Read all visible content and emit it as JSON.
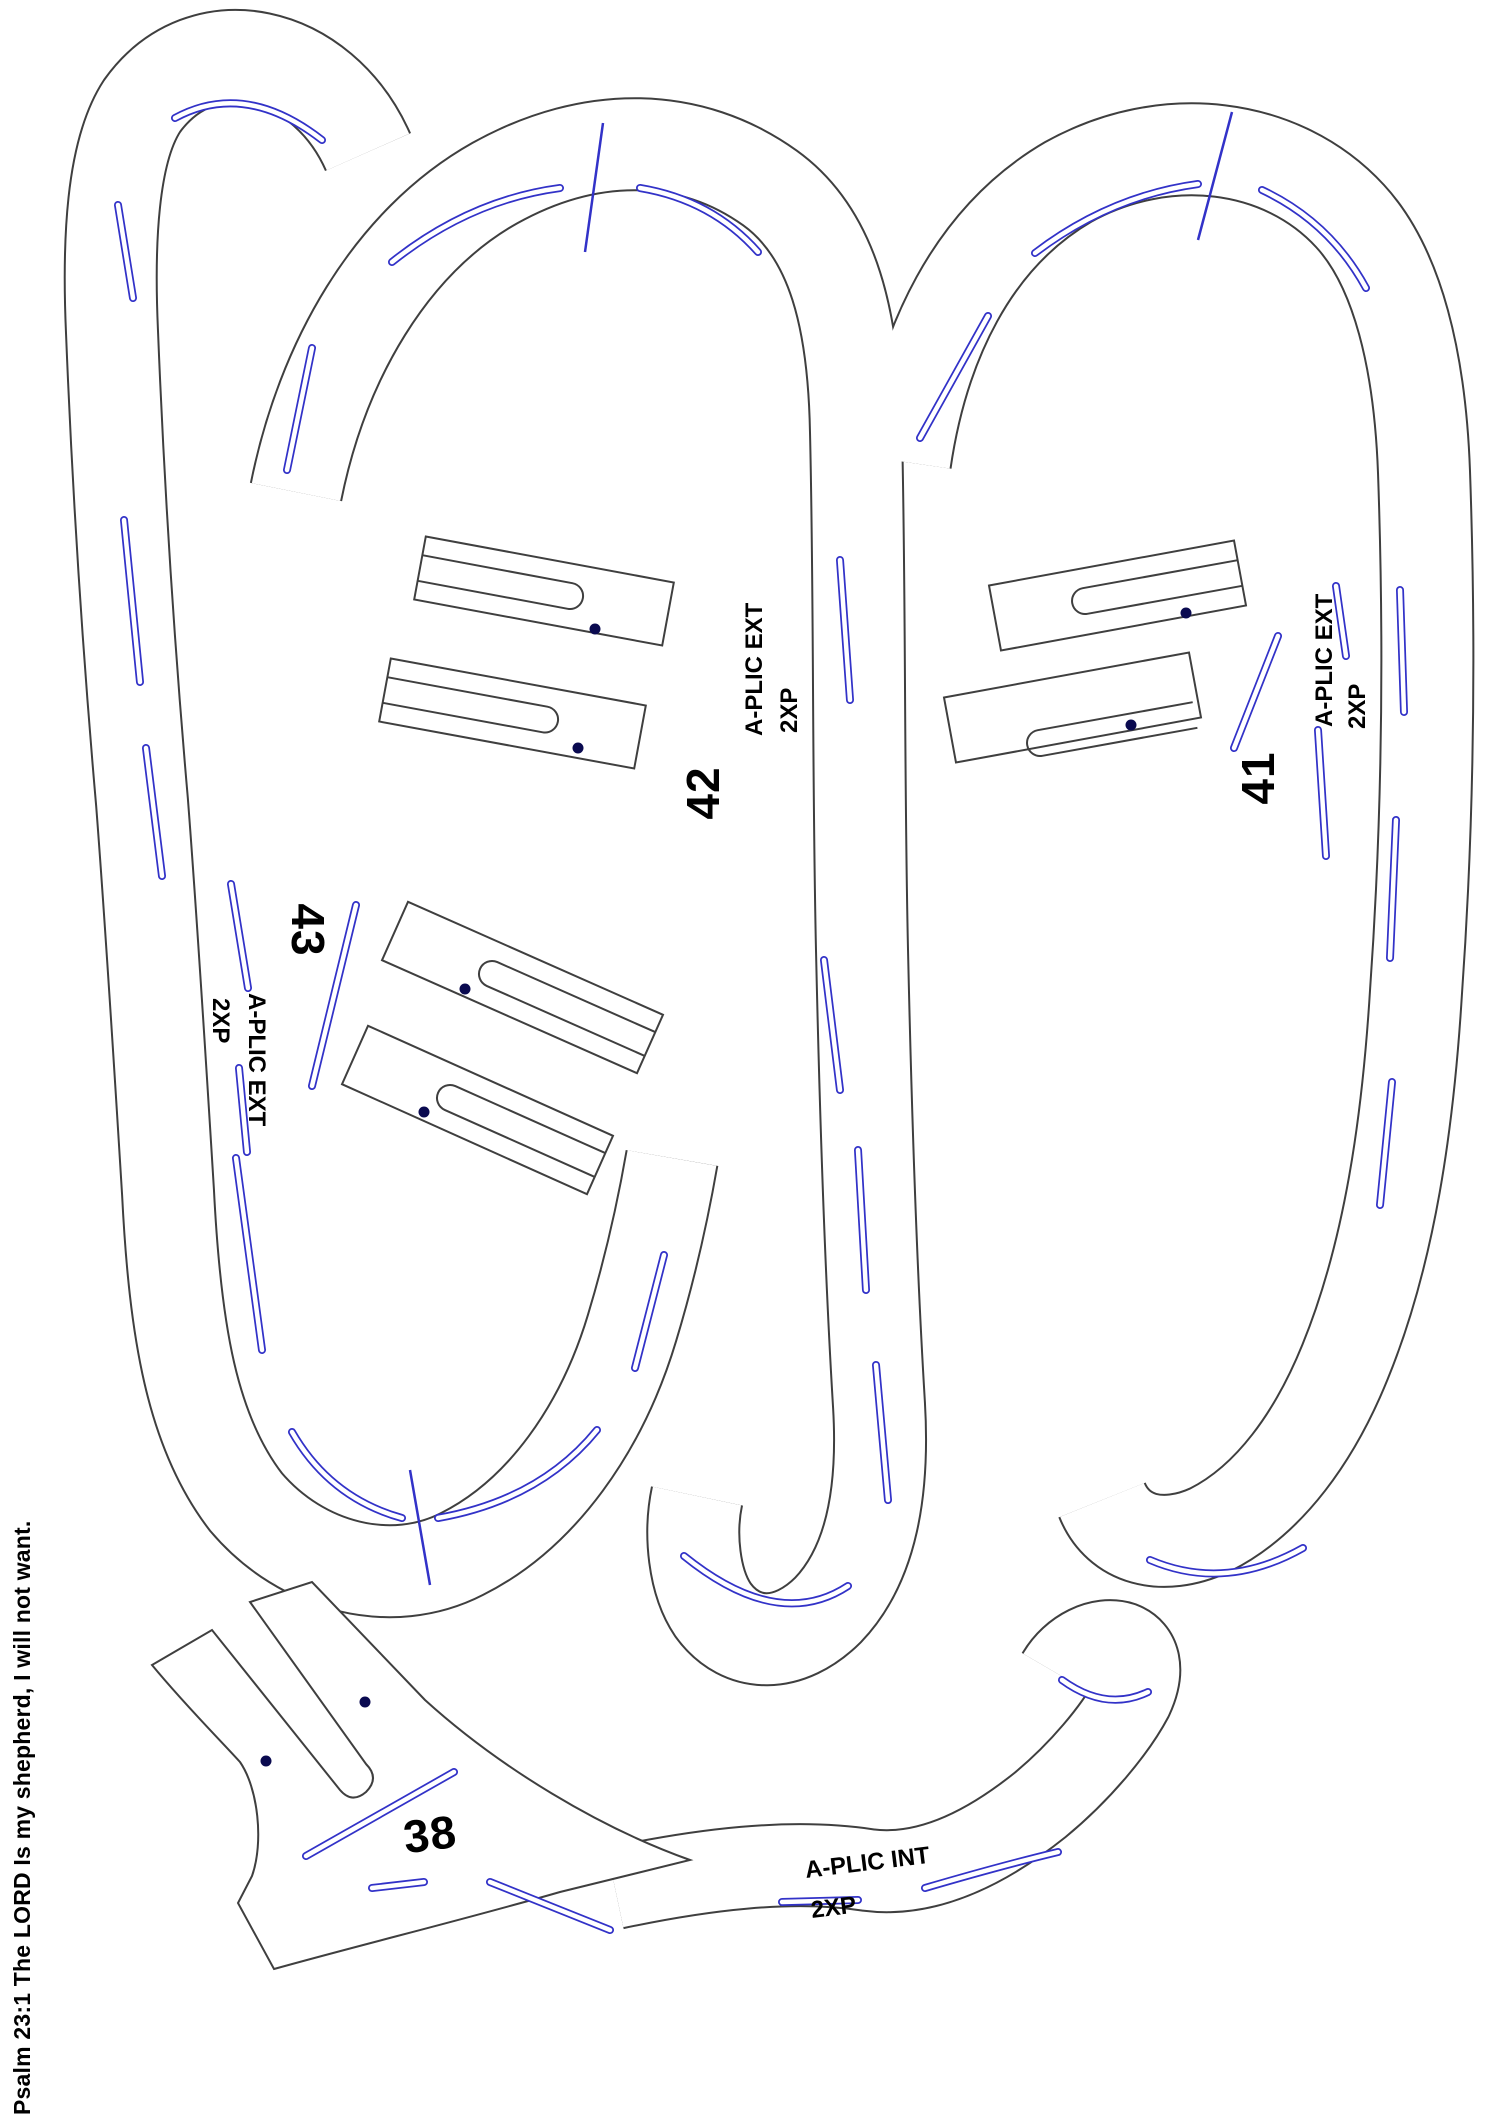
{
  "sheet": {
    "verse_text": "Psalm 23:1 The LORD Is my shepherd, I will not want."
  },
  "pieces": [
    {
      "number": "43",
      "type_label": "A-PLIC EXT",
      "quantity_label": "2XP"
    },
    {
      "number": "42",
      "type_label": "A-PLIC EXT",
      "quantity_label": "2XP"
    },
    {
      "number": "41",
      "type_label": "A-PLIC EXT",
      "quantity_label": "2XP"
    },
    {
      "number": "38",
      "type_label": "A-PLIC INT",
      "quantity_label": "2XP"
    }
  ],
  "colors": {
    "outline": "#3f3f3f",
    "stitch_blue": "#3232c8",
    "hole_dot": "#0a0a50",
    "paper": "#ffffff"
  }
}
